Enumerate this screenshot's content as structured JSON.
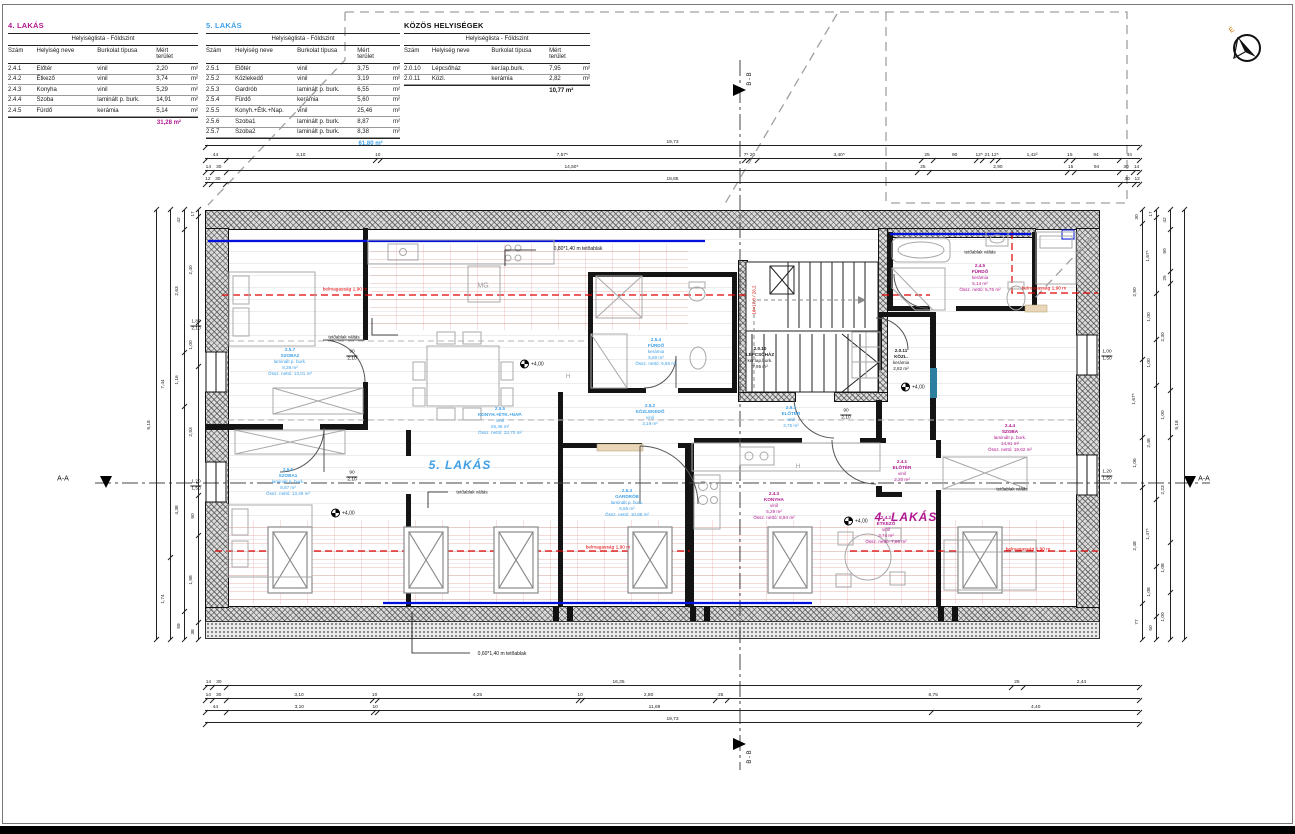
{
  "tables": [
    {
      "title": "4. LAKÁS",
      "accent": "#b01890",
      "subtitle": "Helyiséglista - Földszint",
      "columns": [
        "Szám",
        "Helyiség neve",
        "Burkolat típusa",
        "Mért terület",
        ""
      ],
      "rows": [
        [
          "2.4.1",
          "Előtér",
          "vinil",
          "2,20",
          "m²"
        ],
        [
          "2.4.2",
          "Étkező",
          "vinil",
          "3,74",
          "m²"
        ],
        [
          "2.4.3",
          "Konyha",
          "vinil",
          "5,29",
          "m²"
        ],
        [
          "2.4.4",
          "Szoba",
          "laminált p. burk.",
          "14,91",
          "m²"
        ],
        [
          "2.4.5",
          "Fürdő",
          "kerámia",
          "5,14",
          "m²"
        ]
      ],
      "total": "31,28 m²"
    },
    {
      "title": "5. LAKÁS",
      "accent": "#3fa0e8",
      "subtitle": "Helyiséglista - Földszint",
      "columns": [
        "Szám",
        "Helyiség neve",
        "Burkolat típusa",
        "Mért terület",
        ""
      ],
      "rows": [
        [
          "2.5.1",
          "Előtér",
          "vinil",
          "3,75",
          "m²"
        ],
        [
          "2.5.2",
          "Közlekedő",
          "vinil",
          "3,19",
          "m²"
        ],
        [
          "2.5.3",
          "Gardrób",
          "laminált p. burk.",
          "6,55",
          "m²"
        ],
        [
          "2.5.4",
          "Fürdő",
          "kerámia",
          "5,60",
          "m²"
        ],
        [
          "2.5.5",
          "Konyh.+Étk.+Nap.",
          "vinil",
          "25,46",
          "m²"
        ],
        [
          "2.5.6",
          "Szoba1",
          "laminált p. burk.",
          "8,87",
          "m²"
        ],
        [
          "2.5.7",
          "Szoba2",
          "laminált p. burk.",
          "8,38",
          "m²"
        ]
      ],
      "total": "61,80 m²"
    },
    {
      "title": "KÖZÖS HELYISÉGEK",
      "accent": "#111111",
      "subtitle": "Helyiséglista - Földszint",
      "columns": [
        "Szám",
        "Helyiség neve",
        "Burkolat típusa",
        "Mért terület",
        ""
      ],
      "rows": [
        [
          "2.0.10",
          "Lépcsőház",
          "ker.lap.burk.",
          "7,95",
          "m²"
        ],
        [
          "2.0.11",
          "Közl.",
          "kerámia",
          "2,82",
          "m²"
        ]
      ],
      "total": "10,77 m²"
    }
  ],
  "plan": {
    "apartment_labels": [
      {
        "text": "5. LAKÁS",
        "x": 460,
        "y": 465,
        "color": "#3fa0e8"
      },
      {
        "text": "4. LAKÁS",
        "x": 906,
        "y": 517,
        "color": "#b01890"
      }
    ],
    "rooms": [
      {
        "num": "2.5.7",
        "name": "SZOBA2",
        "lines": [
          "laminált p. burk.",
          "8,38 m²",
          "Össz. nettó: 13,01 m²"
        ],
        "x": 290,
        "y": 362,
        "color": "#3fa0e8"
      },
      {
        "num": "2.5.6",
        "name": "SZOBA1",
        "lines": [
          "laminált p. burk.",
          "8,87 m²",
          "Össz. nettó: 13,49 m²"
        ],
        "x": 288,
        "y": 482,
        "color": "#3fa0e8"
      },
      {
        "num": "2.5.5",
        "name": "KONYH.+ÉTK.+NAP.",
        "lines": [
          "vinil",
          "25,46 m²",
          "Össz. nettó: 33,70 m²"
        ],
        "x": 500,
        "y": 421,
        "color": "#3fa0e8"
      },
      {
        "num": "2.5.4",
        "name": "FÜRDŐ",
        "lines": [
          "kerámia",
          "5,60 m²",
          "Össz. nettó: 6,55 m²"
        ],
        "x": 656,
        "y": 352,
        "color": "#3fa0e8"
      },
      {
        "num": "2.5.3",
        "name": "GARDRÓB",
        "lines": [
          "laminált p. burk.",
          "6,55 m²",
          "Össz. nettó: 10,88 m²"
        ],
        "x": 627,
        "y": 503,
        "color": "#3fa0e8"
      },
      {
        "num": "2.5.2",
        "name": "KÖZLEKEDŐ",
        "lines": [
          "vinil",
          "3,19 m²"
        ],
        "x": 650,
        "y": 415,
        "color": "#3fa0e8"
      },
      {
        "num": "2.5.1",
        "name": "ELŐTÉR",
        "lines": [
          "vinil",
          "3,75 m²"
        ],
        "x": 791,
        "y": 417,
        "color": "#3fa0e8"
      },
      {
        "num": "2.0.10",
        "name": "LÉPCSŐHÁZ",
        "lines": [
          "ker.lap.burk.",
          "7,95 m²"
        ],
        "x": 760,
        "y": 358,
        "color": "#222222"
      },
      {
        "num": "2.0.11",
        "name": "KÖZL.",
        "lines": [
          "kerámia",
          "2,82 m²"
        ],
        "x": 901,
        "y": 360,
        "color": "#222222"
      },
      {
        "num": "2.4.1",
        "name": "ELŐTÉR",
        "lines": [
          "vinil",
          "2,20 m²"
        ],
        "x": 902,
        "y": 471,
        "color": "#b01890"
      },
      {
        "num": "2.4.2",
        "name": "ÉTKEZŐ",
        "lines": [
          "vinil",
          "3,74 m²",
          "Össz. nettó: 7,86 m²"
        ],
        "x": 886,
        "y": 530,
        "color": "#b01890"
      },
      {
        "num": "2.4.3",
        "name": "KONYHA",
        "lines": [
          "vinil",
          "5,29 m²",
          "Össz. nettó: 8,94 m²"
        ],
        "x": 774,
        "y": 506,
        "color": "#b01890"
      },
      {
        "num": "2.4.4",
        "name": "SZOBA",
        "lines": [
          "laminált p. burk.",
          "14,91 m²",
          "Össz. nettó: 19,62 m²"
        ],
        "x": 1010,
        "y": 438,
        "color": "#b01890"
      },
      {
        "num": "2.4.5",
        "name": "FÜRDŐ",
        "lines": [
          "kerámia",
          "5,14 m²",
          "Össz. nettó: 5,76 m²"
        ],
        "x": 980,
        "y": 278,
        "color": "#b01890"
      }
    ],
    "annotations": [
      {
        "text": "belmagasság 1,90 m",
        "x": 345,
        "y": 290,
        "color": "#e00000",
        "size": 4.8
      },
      {
        "text": "belmagasság 1,90 m",
        "x": 1044,
        "y": 289,
        "color": "#e00000",
        "size": 4.8
      },
      {
        "text": "belmagasság 1,90 m",
        "x": 608,
        "y": 548,
        "color": "#e00000",
        "size": 4.8
      },
      {
        "text": "belmagasság 1,90 m",
        "x": 1028,
        "y": 550,
        "color": "#e00000",
        "size": 4.8
      },
      {
        "text": "0,80*1,40 m tetőablak",
        "x": 578,
        "y": 249,
        "color": "#111",
        "size": 5
      },
      {
        "text": "0,60*1,40 m tetőablak",
        "x": 502,
        "y": 654,
        "color": "#111",
        "size": 5
      },
      {
        "text": "tetőablak váltás",
        "x": 344,
        "y": 337,
        "color": "#111",
        "size": 4.5
      },
      {
        "text": "tetőablak váltás",
        "x": 472,
        "y": 492,
        "color": "#111",
        "size": 4.5
      },
      {
        "text": "tetőablak váltás",
        "x": 980,
        "y": 252,
        "color": "#111",
        "size": 4.5
      },
      {
        "text": "tetőablak váltás",
        "x": 1012,
        "y": 489,
        "color": "#111",
        "size": 4.5
      },
      {
        "text": "MG",
        "x": 483,
        "y": 286,
        "color": "#999",
        "size": 7
      },
      {
        "text": "H",
        "x": 798,
        "y": 467,
        "color": "#999",
        "size": 6
      },
      {
        "text": "H",
        "x": 568,
        "y": 377,
        "color": "#999",
        "size": 6
      },
      {
        "text": "16×17,8 / 26,2",
        "x": 754,
        "y": 300,
        "color": "#e00000",
        "size": 4.5,
        "rot": -90
      },
      {
        "text": "A-A",
        "x": 63,
        "y": 479,
        "color": "#111",
        "size": 7
      },
      {
        "text": "A-A",
        "x": 1204,
        "y": 479,
        "color": "#111",
        "size": 7
      },
      {
        "text": "B - B",
        "x": 750,
        "y": 79,
        "color": "#111",
        "size": 6,
        "rot": -90
      },
      {
        "text": "B - B",
        "x": 750,
        "y": 757,
        "color": "#111",
        "size": 6,
        "rot": -90
      }
    ],
    "opening_dims": [
      {
        "w": "90",
        "h": "2,10",
        "x": 352,
        "y": 356
      },
      {
        "w": "90",
        "h": "2,10",
        "x": 352,
        "y": 477
      },
      {
        "w": "90",
        "h": "2,10",
        "x": 846,
        "y": 415
      },
      {
        "w": "1,80",
        "h": "2,10",
        "x": 196,
        "y": 326
      },
      {
        "w": "1,20",
        "h": "1,50",
        "x": 196,
        "y": 486
      },
      {
        "w": "1,00",
        "h": "1,50",
        "x": 1107,
        "y": 356
      },
      {
        "w": "1,20",
        "h": "1,50",
        "x": 1107,
        "y": 476
      }
    ],
    "elevations": [
      {
        "label": "+4,00",
        "x": 522,
        "y": 364
      },
      {
        "label": "+4,00",
        "x": 333,
        "y": 513
      },
      {
        "label": "+4,00",
        "x": 846,
        "y": 521
      },
      {
        "label": "+4,00",
        "x": 903,
        "y": 387
      }
    ]
  },
  "dimensions": {
    "top": [
      [
        "19,73"
      ],
      [
        "44",
        "3,10",
        "10",
        "7,57⁵",
        "7⁵",
        "20",
        "3,40⁵",
        "25",
        "90",
        "12⁵",
        "21",
        "12⁵",
        "1,42²",
        "15",
        "94",
        "44"
      ],
      [
        "14",
        "30",
        "14,50⁵",
        "25",
        "2,90",
        "15",
        "94",
        "30",
        "14"
      ],
      [
        "12",
        "30",
        "18,85",
        "30",
        "12"
      ]
    ],
    "bottom": [
      [
        "14",
        "30",
        "16,35",
        "25",
        "2,44"
      ],
      [
        "14",
        "30",
        "3,10",
        "10",
        "4,25",
        "10",
        "2,80",
        "25",
        "8,75"
      ],
      [
        "44",
        "3,10",
        "10",
        "11,69",
        "4,40"
      ],
      [
        "19,73"
      ]
    ],
    "left": [
      [
        "9,18"
      ],
      [
        "7,44",
        "1,74"
      ],
      [
        "42",
        "2,63",
        "1,16",
        "4,38",
        "59"
      ],
      [
        "17",
        "2,40",
        "1,00",
        "2,93",
        "90",
        "1,98",
        "38"
      ]
    ],
    "right": [
      [
        "30",
        "2,90",
        "1,67⁵",
        "1,06",
        "2,48",
        "77"
      ],
      [
        "17",
        "1,67⁵",
        "1,00",
        "1,00",
        "2,48",
        "1,47⁵",
        "1,08",
        "50"
      ],
      [
        "42",
        "90",
        "25",
        "2,30",
        "1,00",
        "2,23",
        "1,08",
        "1,00"
      ],
      [
        "9,18"
      ]
    ]
  },
  "compass": {
    "label": "É"
  }
}
